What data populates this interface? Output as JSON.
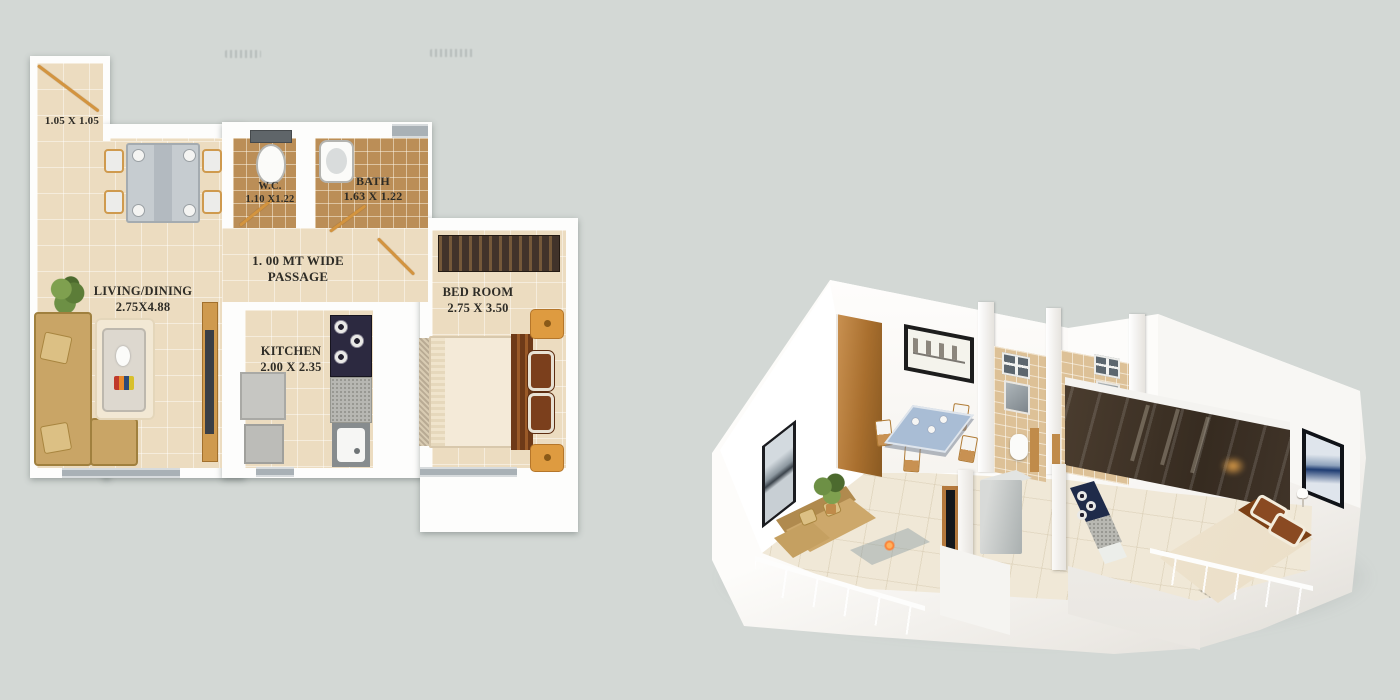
{
  "canvas": {
    "width": 1400,
    "height": 700,
    "background": "#d3d8d5"
  },
  "floorplan_2d": {
    "labels": {
      "entry": {
        "dim": "1.05 X 1.05"
      },
      "living_dining": {
        "name": "LIVING/DINING",
        "dim": "2.75X4.88"
      },
      "wc": {
        "name": "W.C.",
        "dim": "1.10 X1.22"
      },
      "bath": {
        "name": "BATH",
        "dim": "1.63 X 1.22"
      },
      "passage": {
        "line1": "1. 00 MT WIDE",
        "line2": "PASSAGE"
      },
      "kitchen": {
        "name": "KITCHEN",
        "dim": "2.00 X 2.35"
      },
      "bedroom": {
        "name": "BED ROOM",
        "dim": "2.75 X 3.50"
      }
    },
    "palette": {
      "wall": "#fdfdfc",
      "floor": "#ecdcc0",
      "bath_tile": "#bb8e57",
      "wood_door": "#d3943f",
      "sofa": "#c9a566",
      "counter": "#b7b7b2",
      "stove": "#2c2940",
      "wardrobe": "#41332a",
      "window": "#a9b1b6",
      "label_text": "#2e2c26"
    }
  },
  "render_3d": {
    "palette": {
      "wall": "#f7f6f3",
      "floor": "#f0e8d7",
      "bath_tile": "#ddc197",
      "wood_door": "#a96f2e",
      "sofa": "#cda86b",
      "balcony_glass": "#c4d6da",
      "bed": "#f2e8d6",
      "pillow": "#8a4a22",
      "wardrobe": "#4a3b2e",
      "stove": "#1f2b4a"
    }
  }
}
